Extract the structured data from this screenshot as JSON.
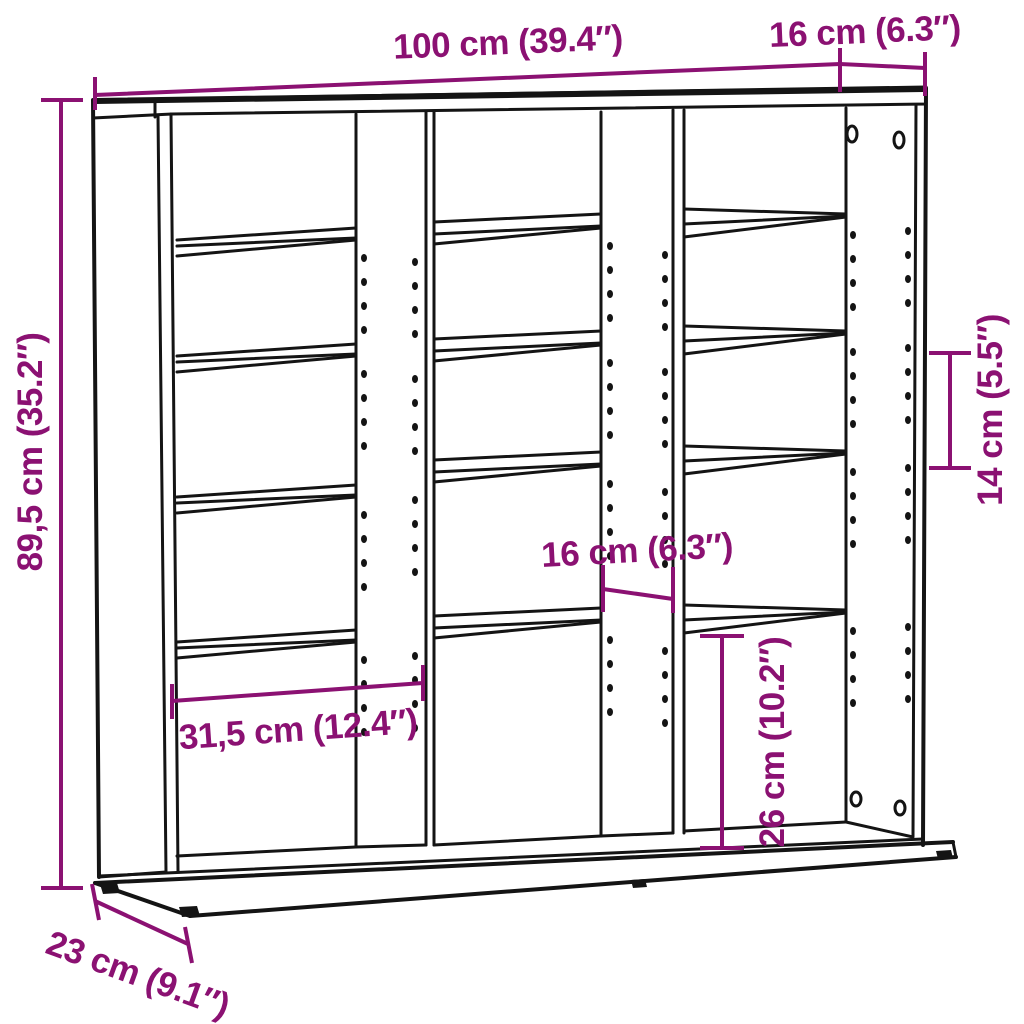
{
  "page": {
    "background": "#ffffff"
  },
  "diagram": {
    "title": "Shelf unit dimension diagram",
    "product": "CD storage shelf with three columns, adjustable shelves, wall-mount holes and plinth base",
    "style": {
      "line_color": "#141414",
      "dimension_color": "#8B1172"
    },
    "dimensions": {
      "width_top": "100 cm (39.4″)",
      "depth_top_right": "16 cm (6.3″)",
      "height_left": "89,5 cm (35.2″)",
      "shelf_spacing_right": "14 cm (5.5″)",
      "inner_depth_middle": "16 cm (6.3″)",
      "inner_width_left": "31,5 cm (12.4″)",
      "bottom_compartment_height": "26 cm (10.2″)",
      "base_depth_bottom": "23 cm (9.1″)"
    }
  }
}
